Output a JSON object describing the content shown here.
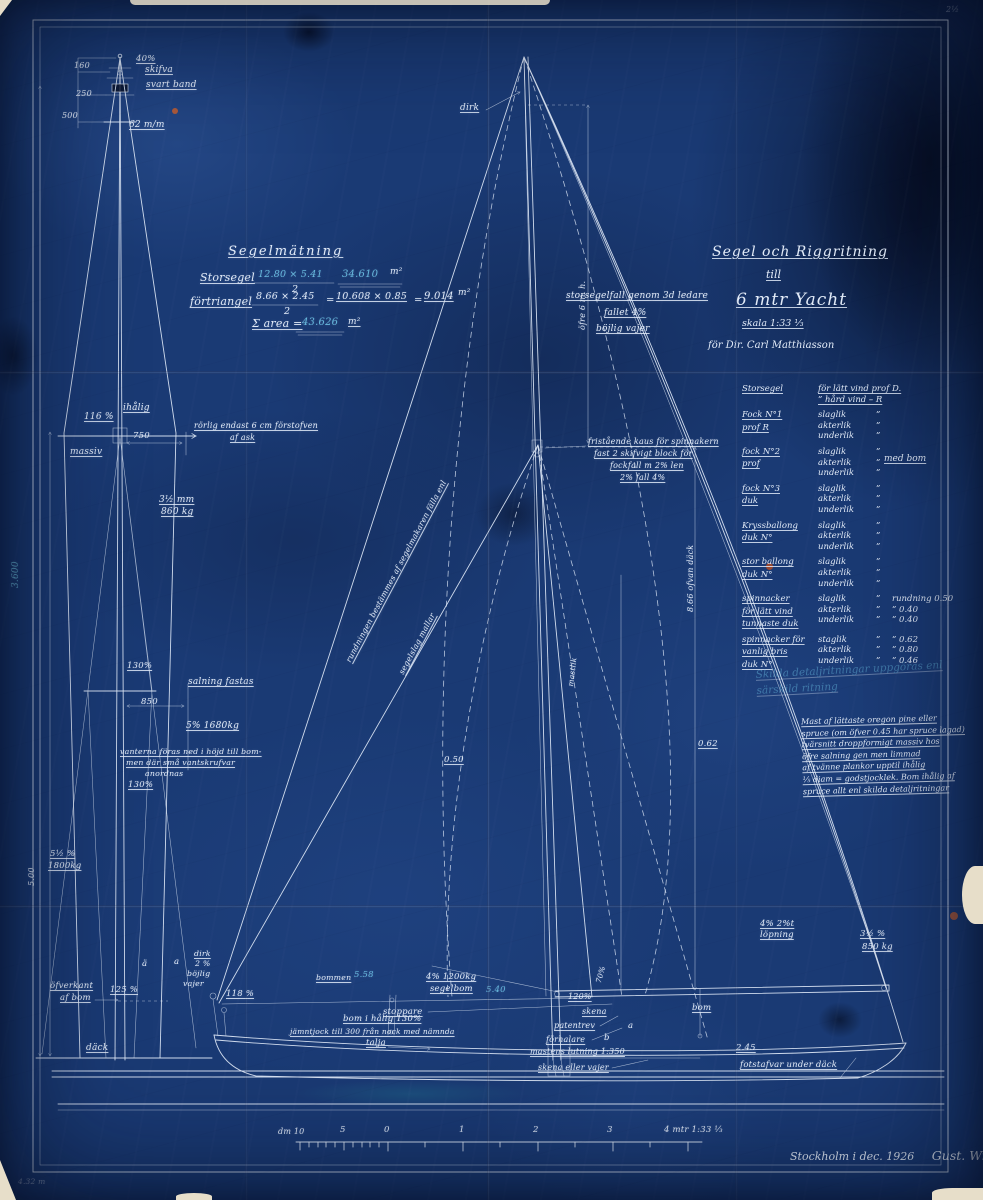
{
  "palette": {
    "paper_blue": "#1a3a74",
    "ink_white": "#e2ebf8",
    "pencil_cyan": "#6fc6e8",
    "paper_cream": "#e7dec9",
    "rust": "#b85c33"
  },
  "title_block": {
    "line1": "Segel och Riggritning",
    "line2": "till",
    "line3": "6 mtr Yacht",
    "scale": "skala 1:33 ⅓",
    "client": "för Dir. Carl Matthiasson"
  },
  "measurement_labels": [
    {
      "t": "Segelmätning",
      "x": 228,
      "y": 245,
      "fs": 13,
      "u": 1,
      "ls": 2
    },
    {
      "t": "Storsegel",
      "x": 200,
      "y": 272,
      "fs": 11,
      "u": 1
    },
    {
      "t": "12.80 × 5.41",
      "x": 258,
      "y": 270,
      "fs": 9.5,
      "c": "cyan"
    },
    {
      "t": "2",
      "x": 292,
      "y": 285,
      "fs": 9.5
    },
    {
      "t": "34.610",
      "x": 342,
      "y": 270,
      "fs": 10,
      "c": "cyan"
    },
    {
      "t": "m²",
      "x": 390,
      "y": 268,
      "fs": 9
    },
    {
      "t": "förtriangel",
      "x": 190,
      "y": 296,
      "fs": 11,
      "u": 1
    },
    {
      "t": "8.66 × 2.45",
      "x": 256,
      "y": 292,
      "fs": 9.5
    },
    {
      "t": "2",
      "x": 284,
      "y": 307,
      "fs": 9.5
    },
    {
      "t": "=",
      "x": 326,
      "y": 296,
      "fs": 10
    },
    {
      "t": "10.608 × 0.85",
      "x": 336,
      "y": 292,
      "fs": 9.5,
      "u": 1
    },
    {
      "t": "=",
      "x": 414,
      "y": 296,
      "fs": 10
    },
    {
      "t": "9.014",
      "x": 424,
      "y": 292,
      "fs": 10,
      "u": 1
    },
    {
      "t": "m²",
      "x": 458,
      "y": 289,
      "fs": 9
    },
    {
      "t": "Σ area =",
      "x": 252,
      "y": 318,
      "fs": 11,
      "u": 1
    },
    {
      "t": "43.626",
      "x": 302,
      "y": 318,
      "fs": 10,
      "c": "cyan"
    },
    {
      "t": "m²",
      "x": 348,
      "y": 318,
      "fs": 9,
      "u": 1
    }
  ],
  "mast_labels": [
    {
      "t": "40%",
      "x": 136,
      "y": 55,
      "fs": 8.5,
      "u": 1
    },
    {
      "t": "skifva",
      "x": 145,
      "y": 66,
      "fs": 9,
      "u": 1
    },
    {
      "t": "160",
      "x": 74,
      "y": 62,
      "fs": 8
    },
    {
      "t": "250",
      "x": 76,
      "y": 90,
      "fs": 8
    },
    {
      "t": "svart band",
      "x": 146,
      "y": 81,
      "fs": 9,
      "u": 1
    },
    {
      "t": "500",
      "x": 62,
      "y": 112,
      "fs": 8
    },
    {
      "t": "62 m/m",
      "x": 129,
      "y": 121,
      "fs": 9,
      "u": 1
    },
    {
      "t": "116 %",
      "x": 84,
      "y": 413,
      "fs": 9,
      "u": 1
    },
    {
      "t": "ihålig",
      "x": 123,
      "y": 404,
      "fs": 9,
      "u": 1
    },
    {
      "t": "750",
      "x": 133,
      "y": 432,
      "fs": 8.5
    },
    {
      "t": "massiv",
      "x": 70,
      "y": 448,
      "fs": 9,
      "u": 1
    },
    {
      "t": "rörlig endast 6 cm förstofven",
      "x": 194,
      "y": 422,
      "fs": 8,
      "u": 1
    },
    {
      "t": "af ask",
      "x": 230,
      "y": 434,
      "fs": 8,
      "u": 1
    },
    {
      "t": "3½ mm",
      "x": 159,
      "y": 496,
      "fs": 9,
      "u": 1
    },
    {
      "t": "860 kg",
      "x": 161,
      "y": 508,
      "fs": 9,
      "u": 1
    },
    {
      "t": "3.600",
      "x": 12,
      "y": 588,
      "fs": 9,
      "rot": -90,
      "c": "cyan"
    },
    {
      "t": "130%",
      "x": 127,
      "y": 662,
      "fs": 8.5,
      "u": 1
    },
    {
      "t": "salning fastas",
      "x": 188,
      "y": 678,
      "fs": 9,
      "u": 1
    },
    {
      "t": "850",
      "x": 141,
      "y": 698,
      "fs": 8.5
    },
    {
      "t": "5% 1680kg",
      "x": 186,
      "y": 722,
      "fs": 9,
      "u": 1
    },
    {
      "t": "vanterna föras ned i höjd till bom-",
      "x": 120,
      "y": 748,
      "fs": 7.8,
      "u": 1
    },
    {
      "t": "men där små vantskrufvar",
      "x": 126,
      "y": 759,
      "fs": 7.8,
      "u": 1
    },
    {
      "t": "anordnas",
      "x": 145,
      "y": 770,
      "fs": 7.8
    },
    {
      "t": "130%",
      "x": 128,
      "y": 781,
      "fs": 8.5,
      "u": 1
    },
    {
      "t": "5½ %",
      "x": 50,
      "y": 850,
      "fs": 8.5,
      "u": 1
    },
    {
      "t": "1800kg",
      "x": 48,
      "y": 862,
      "fs": 8.5,
      "u": 1
    },
    {
      "t": "5.00",
      "x": 28,
      "y": 886,
      "fs": 8,
      "rot": -90
    },
    {
      "t": "öfverkant",
      "x": 50,
      "y": 982,
      "fs": 8.5,
      "u": 1
    },
    {
      "t": "af bom",
      "x": 60,
      "y": 994,
      "fs": 8.5,
      "u": 1
    },
    {
      "t": "125 %",
      "x": 110,
      "y": 986,
      "fs": 8.5,
      "u": 1
    },
    {
      "t": "däck",
      "x": 86,
      "y": 1044,
      "fs": 9,
      "u": 1
    },
    {
      "t": "ä",
      "x": 142,
      "y": 960,
      "fs": 8.5
    },
    {
      "t": "a",
      "x": 174,
      "y": 958,
      "fs": 8.5
    },
    {
      "t": "dirk",
      "x": 194,
      "y": 950,
      "fs": 7.8,
      "u": 1
    },
    {
      "t": "2 %",
      "x": 195,
      "y": 960,
      "fs": 7.8
    },
    {
      "t": "böjlig",
      "x": 187,
      "y": 970,
      "fs": 7.8
    },
    {
      "t": "vajer",
      "x": 183,
      "y": 980,
      "fs": 7.8
    }
  ],
  "sailplan_labels": [
    {
      "t": "dirk",
      "x": 460,
      "y": 104,
      "fs": 9,
      "u": 1
    },
    {
      "t": "öfre 6 m. h.",
      "x": 579,
      "y": 330,
      "fs": 8,
      "rot": -90
    },
    {
      "t": "storsegelfall genom 3d ledare",
      "x": 566,
      "y": 292,
      "fs": 9,
      "u": 1
    },
    {
      "t": "fallet 4%",
      "x": 604,
      "y": 309,
      "fs": 9,
      "u": 1
    },
    {
      "t": "böjlig vajer",
      "x": 596,
      "y": 325,
      "fs": 9,
      "u": 1
    },
    {
      "t": "fristående kaus för spinnakern",
      "x": 588,
      "y": 438,
      "fs": 8,
      "u": 1
    },
    {
      "t": "fast 2 skifvigt block för",
      "x": 594,
      "y": 450,
      "fs": 8,
      "u": 1
    },
    {
      "t": "fockfall m 2% len",
      "x": 610,
      "y": 462,
      "fs": 8,
      "u": 1
    },
    {
      "t": "2% fall 4%",
      "x": 620,
      "y": 474,
      "fs": 8,
      "u": 1
    },
    {
      "t": "rundningen bestämmes af segelmakaren fälla enl",
      "x": 345,
      "y": 660,
      "fs": 7.8,
      "rot": -62,
      "u": 1
    },
    {
      "t": "segelslag mallar",
      "x": 398,
      "y": 672,
      "fs": 7.8,
      "rot": -62,
      "u": 1
    },
    {
      "t": "mastlik",
      "x": 567,
      "y": 686,
      "fs": 7.5,
      "rot": -83
    },
    {
      "t": "8.66 ofvan däck",
      "x": 687,
      "y": 612,
      "fs": 8,
      "rot": -90
    },
    {
      "t": "0.62",
      "x": 698,
      "y": 740,
      "fs": 8.5,
      "u": 1
    },
    {
      "t": "0.50",
      "x": 444,
      "y": 756,
      "fs": 8.5,
      "u": 1
    },
    {
      "t": "4% 2%t",
      "x": 760,
      "y": 920,
      "fs": 8.5,
      "u": 1
    },
    {
      "t": "löpning",
      "x": 760,
      "y": 931,
      "fs": 8.5,
      "u": 1
    },
    {
      "t": "3½ %",
      "x": 860,
      "y": 930,
      "fs": 8.5,
      "u": 1
    },
    {
      "t": "850 kg",
      "x": 862,
      "y": 943,
      "fs": 8.5,
      "u": 1
    },
    {
      "t": "bommen",
      "x": 316,
      "y": 974,
      "fs": 7.8,
      "u": 1
    },
    {
      "t": "5.58",
      "x": 354,
      "y": 971,
      "fs": 8.5,
      "c": "cyan"
    },
    {
      "t": "118 %",
      "x": 226,
      "y": 990,
      "fs": 8.5,
      "u": 1
    },
    {
      "t": "4% 1200kg",
      "x": 426,
      "y": 973,
      "fs": 8.5,
      "u": 1
    },
    {
      "t": "segelbom",
      "x": 430,
      "y": 985,
      "fs": 8.5,
      "u": 1
    },
    {
      "t": "5.40",
      "x": 486,
      "y": 986,
      "fs": 8.5,
      "c": "cyan"
    },
    {
      "t": "stoppare",
      "x": 383,
      "y": 1008,
      "fs": 8.5,
      "u": 1
    },
    {
      "t": "bom i hålig 130%",
      "x": 343,
      "y": 1015,
      "fs": 8.5,
      "u": 1
    },
    {
      "t": "jämntjock till 300 från nock med nämnda",
      "x": 290,
      "y": 1028,
      "fs": 7.5,
      "u": 1
    },
    {
      "t": "talja",
      "x": 366,
      "y": 1039,
      "fs": 8.5,
      "u": 1
    },
    {
      "t": "120%",
      "x": 568,
      "y": 993,
      "fs": 8,
      "u": 1
    },
    {
      "t": "70%",
      "x": 595,
      "y": 982,
      "fs": 7.5,
      "rot": -75
    },
    {
      "t": "skena",
      "x": 582,
      "y": 1008,
      "fs": 8,
      "u": 1
    },
    {
      "t": "patentrev",
      "x": 554,
      "y": 1022,
      "fs": 8,
      "u": 1
    },
    {
      "t": "förhalare",
      "x": 546,
      "y": 1036,
      "fs": 8,
      "u": 1
    },
    {
      "t": "mastens lutning 1:350",
      "x": 530,
      "y": 1048,
      "fs": 8,
      "u": 1
    },
    {
      "t": "skena eller vajer",
      "x": 538,
      "y": 1064,
      "fs": 8,
      "u": 1
    },
    {
      "t": "a",
      "x": 628,
      "y": 1022,
      "fs": 8.5
    },
    {
      "t": "b",
      "x": 604,
      "y": 1034,
      "fs": 8.5
    },
    {
      "t": "bom",
      "x": 692,
      "y": 1004,
      "fs": 8.5,
      "u": 1
    },
    {
      "t": "2.45",
      "x": 736,
      "y": 1044,
      "fs": 8.5,
      "u": 1
    },
    {
      "t": "fotstafvar under däck",
      "x": 740,
      "y": 1061,
      "fs": 8.5,
      "u": 1
    }
  ],
  "rig_table": {
    "note": "med bom",
    "header": {
      "c1": "Storsegel",
      "c2": [
        "för lätt vind prof D.",
        "”  hård vind  –  R"
      ]
    },
    "groups": [
      {
        "names": [
          "Fock N°1",
          "prof R"
        ],
        "rows": [
          [
            "slaglik",
            "”"
          ],
          [
            "akterlik",
            "”"
          ],
          [
            "underlik",
            "”"
          ]
        ]
      },
      {
        "names": [
          "fock N°2",
          "prof"
        ],
        "rows": [
          [
            "slaglik",
            "”"
          ],
          [
            "akterlik",
            "”"
          ],
          [
            "underlik",
            "”"
          ]
        ]
      },
      {
        "names": [
          "fock N°3",
          "duk"
        ],
        "rows": [
          [
            "slaglik",
            "”"
          ],
          [
            "akterlik",
            "”"
          ],
          [
            "underlik",
            "”"
          ]
        ]
      },
      {
        "names": [
          "Kryssballong",
          "duk N°"
        ],
        "rows": [
          [
            "slaglik",
            "”"
          ],
          [
            "akterlik",
            "”"
          ],
          [
            "underlik",
            "”"
          ]
        ]
      },
      {
        "names": [
          "stor ballong",
          "duk N°"
        ],
        "rows": [
          [
            "slaglik",
            "”"
          ],
          [
            "akterlik",
            "”"
          ],
          [
            "underlik",
            "”"
          ]
        ]
      },
      {
        "names": [
          "spinnacker",
          "för lätt vind",
          "tunnaste duk"
        ],
        "rows": [
          [
            "slaglik",
            "”",
            "rundning 0.50"
          ],
          [
            "akterlik",
            "”",
            "”   0.40"
          ],
          [
            "underlik",
            "”",
            "”   0.40"
          ]
        ]
      },
      {
        "names": [
          "spinnacker för",
          "vanlig bris",
          "duk N°"
        ],
        "rows": [
          [
            "staglik",
            "”",
            "”   0.62"
          ],
          [
            "akterlik",
            "”",
            "”   0.80"
          ],
          [
            "underlik",
            "”",
            "”   0.46"
          ]
        ]
      }
    ]
  },
  "notes": {
    "lines": [
      "Mast af lättaste oregon pine eller",
      "spruce (om öfver 0.45 har spruce lagad)",
      "tvärsnitt droppformigt  massiv hos",
      "öfre salning gen men limmad",
      "af tvänne plankor upptil ihålig",
      "⅕ diam = godstjocklek. Bom ihålig af",
      "spruce allt enl skilda detaljritningar"
    ]
  },
  "faint_note": {
    "lines": [
      "Skilda detaljritningar uppgöras enl",
      "särskild ritning"
    ]
  },
  "scale_labels": [
    {
      "t": "dm 10",
      "x": 278,
      "y": 1128,
      "fs": 8
    },
    {
      "t": "5",
      "x": 340,
      "y": 1126,
      "fs": 8.5
    },
    {
      "t": "0",
      "x": 384,
      "y": 1126,
      "fs": 8.5
    },
    {
      "t": "1",
      "x": 459,
      "y": 1126,
      "fs": 8.5
    },
    {
      "t": "2",
      "x": 533,
      "y": 1126,
      "fs": 8.5
    },
    {
      "t": "3",
      "x": 607,
      "y": 1126,
      "fs": 8.5
    },
    {
      "t": "4 mtr  1:33 ⅓",
      "x": 664,
      "y": 1126,
      "fs": 8.5
    }
  ],
  "corner_marks": [
    {
      "t": "4.32 m",
      "x": 18,
      "y": 1178,
      "fs": 7.5,
      "c": "faint"
    },
    {
      "t": "2½",
      "x": 946,
      "y": 6,
      "fs": 8,
      "c": "faint"
    }
  ],
  "signature": {
    "place": "Stockholm i dec. 1926",
    "name": "Gust. Willands."
  }
}
